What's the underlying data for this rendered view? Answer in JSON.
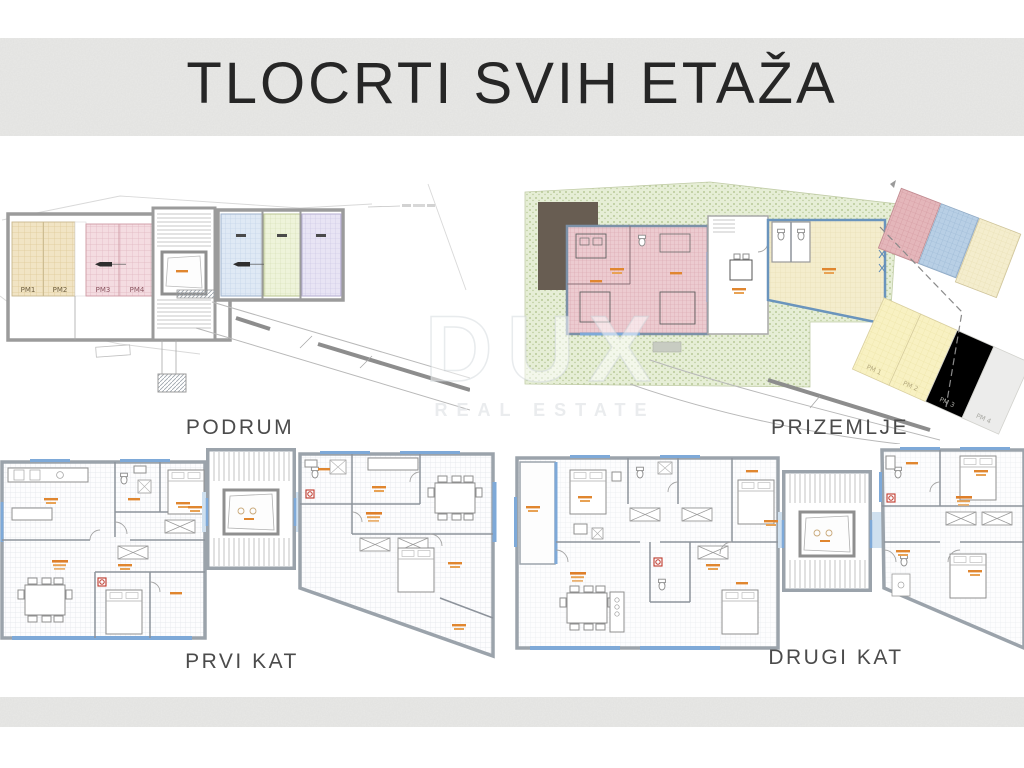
{
  "slide": {
    "title": "TLOCRTI SVIH ETAŽA"
  },
  "watermark": {
    "brand": "DUX",
    "tagline": "REAL ESTATE"
  },
  "floors": {
    "podrum": {
      "label": "PODRUM",
      "parking": [
        "PM1",
        "PM2",
        "PM3",
        "PM4"
      ]
    },
    "prizemlje": {
      "label": "PRIZEMLJE",
      "parking": [
        "PM 1",
        "PM 2",
        "PM 3",
        "PM 4"
      ]
    },
    "prvi_kat": {
      "label": "PRVI KAT"
    },
    "drugi_kat": {
      "label": "DRUGI KAT"
    }
  },
  "colors": {
    "band_gray": "#e9e9e7",
    "garden_green": "#e6eed6",
    "plan_pink": "#eccbd0",
    "plan_tan": "#f1e4c4",
    "plan_blue": "#dfe9f5",
    "accent_blue": "#7ea9d8",
    "label_orange": "#e0862f",
    "alert_red": "#c0392b"
  }
}
